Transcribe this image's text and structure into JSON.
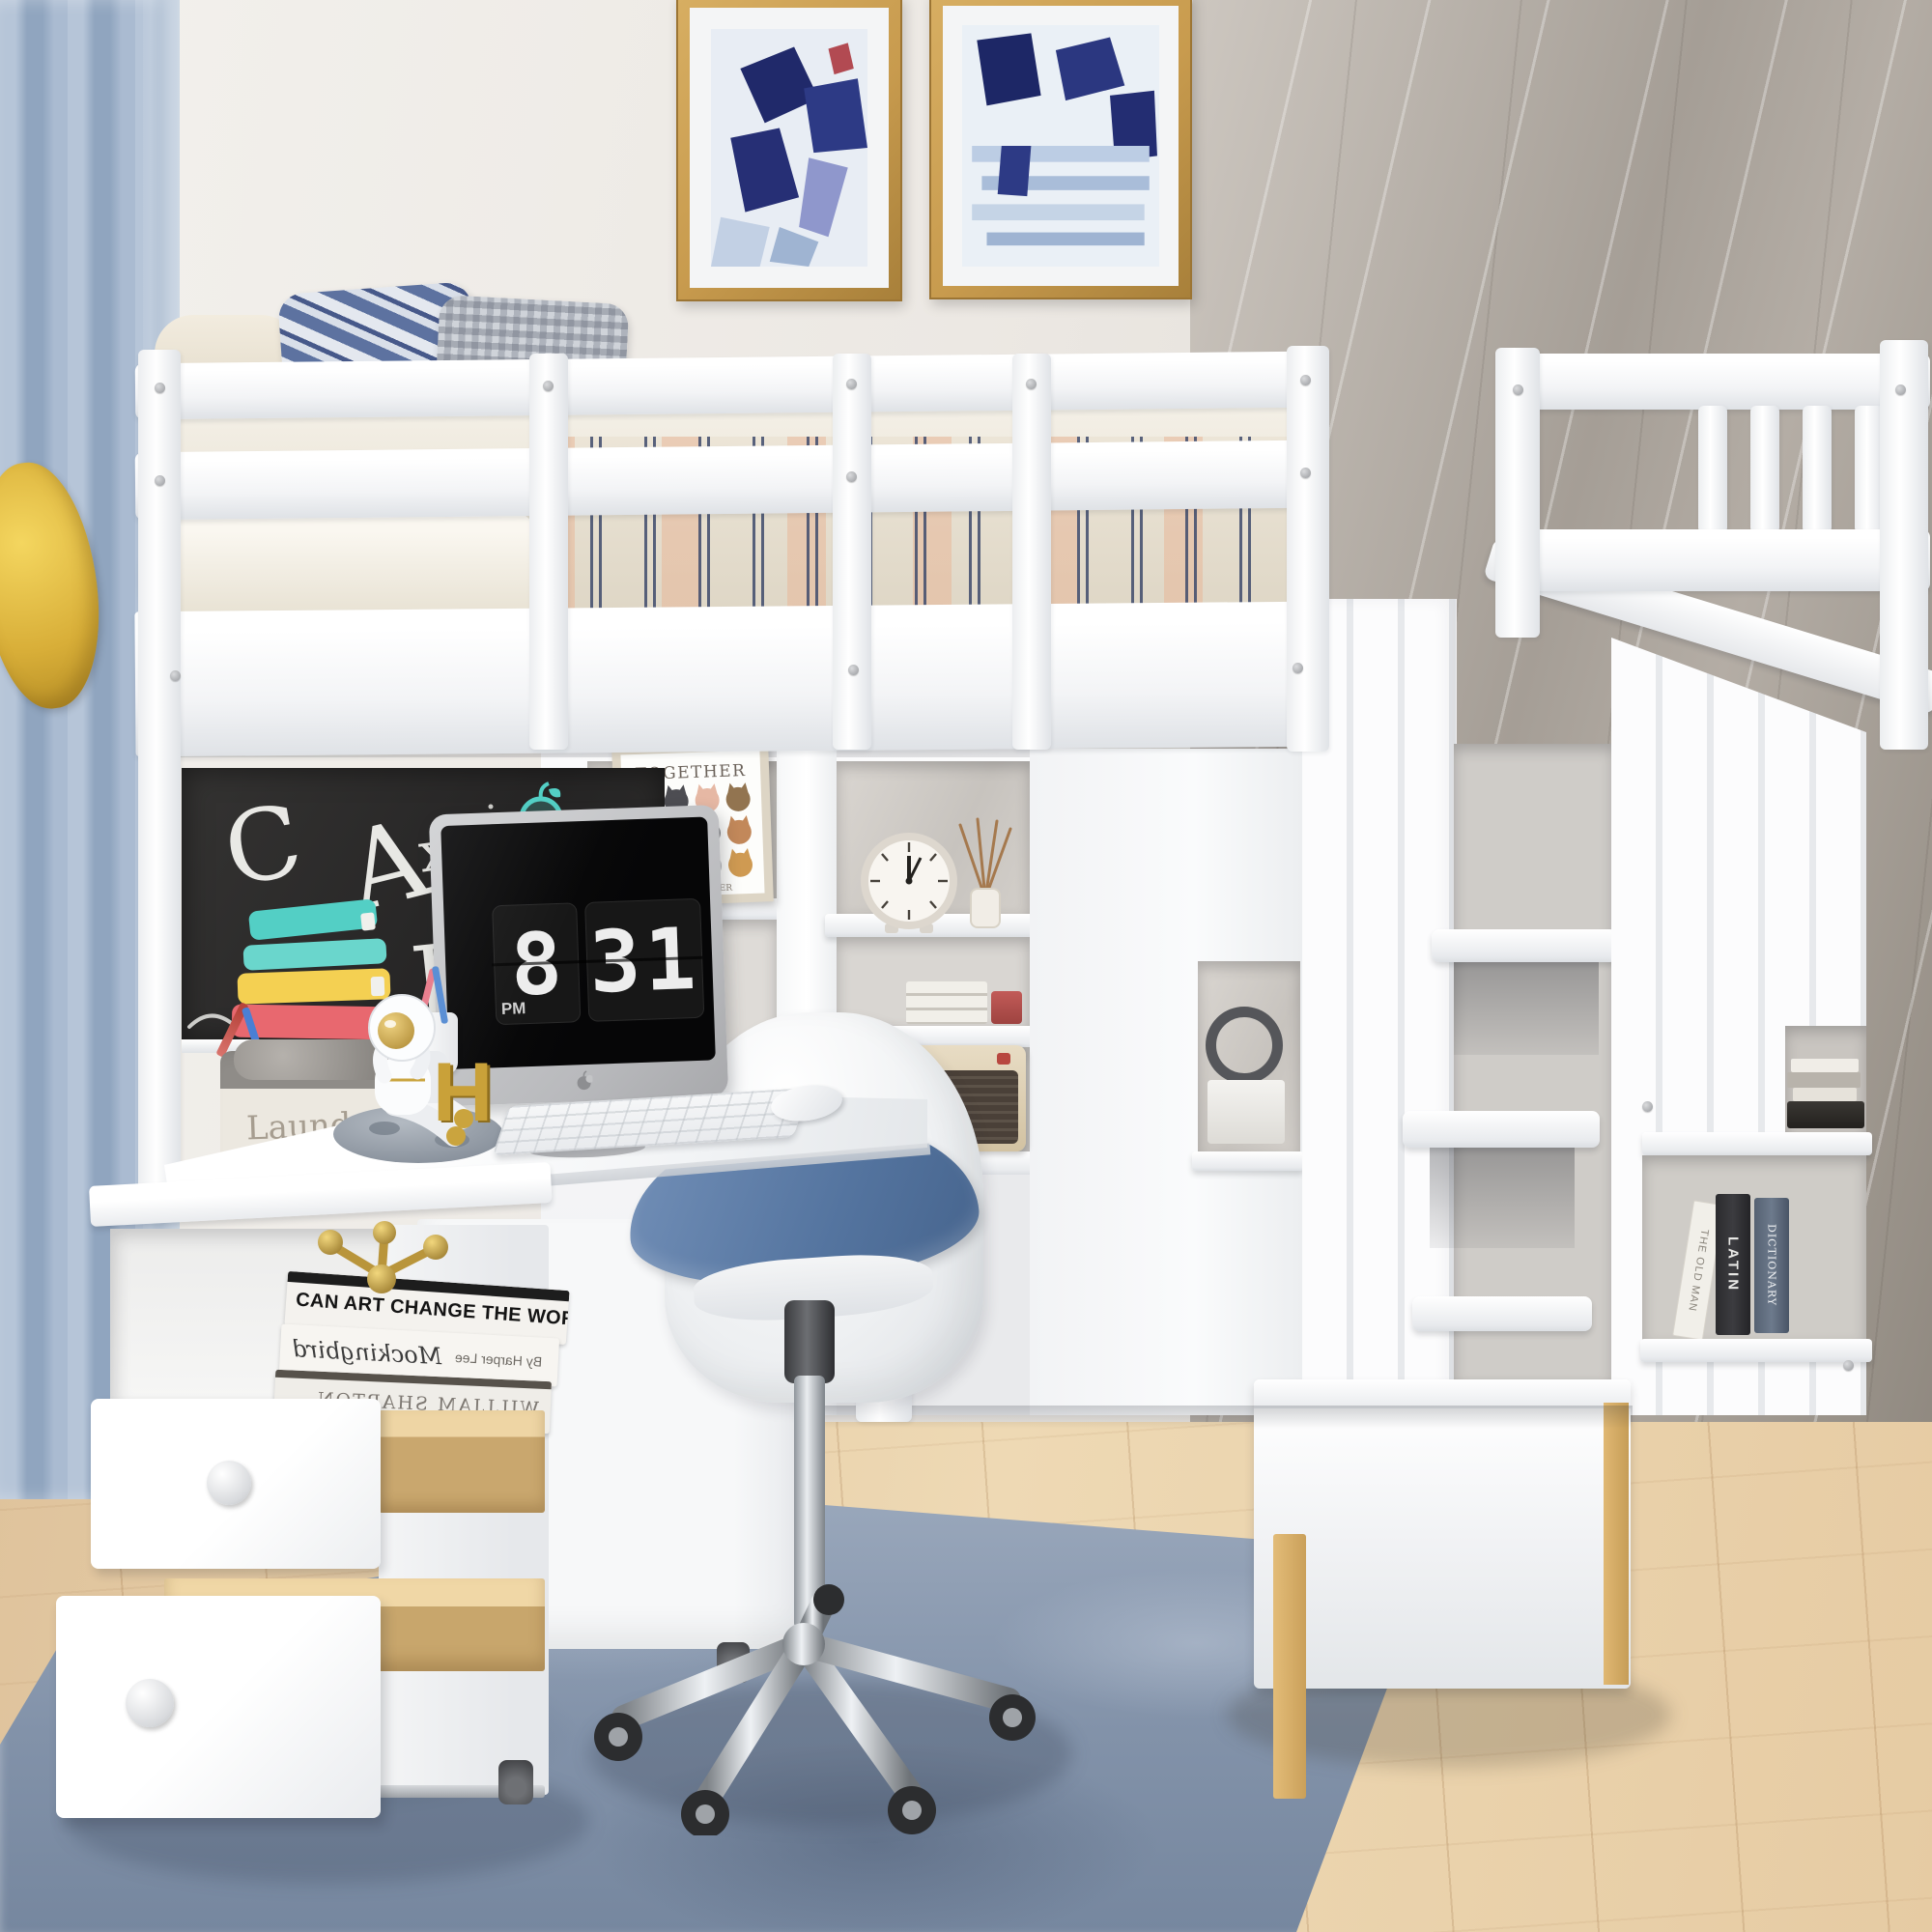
{
  "scene": {
    "subject": "Kids bedroom product photo: white twin loft bed with built-in desk, shelves, chalkboard, rolling drawer cart and storage staircase",
    "setting": "bedroom with blue curtains, marble wall, wood floor and blue rug"
  },
  "chalkboard": {
    "letter_c": "C",
    "letter_a": "A",
    "letter_x": "x",
    "letter_b": "B"
  },
  "computer_screen": {
    "clock_hour": "8",
    "clock_minutes": "31",
    "clock_meridiem": "PM"
  },
  "cat_poster": {
    "title": "TOGETHER",
    "caption": "WE ARE POWER"
  },
  "laundry_basket": {
    "label": "Laundry"
  },
  "bookend": {
    "letter": "H"
  },
  "books": {
    "stack_top_title": "CAN ART CHANGE THE WORLD?",
    "stack_mid_title": "Mockingbird",
    "stack_mid_author": "By Harper Lee",
    "stack_bottom_title": "WILLIAM SHARTON",
    "spine_latin": "LATIN",
    "spine_dictionary": "DICTIONARY",
    "spine_leaning": "THE OLD MAN"
  },
  "colors": {
    "furniture_white": "#ffffff",
    "wall_white": "#f0ede9",
    "marble_gray": "#a9a29a",
    "curtain_blue": "#a9bcd3",
    "curtain_tie_yellow": "#e9c94f",
    "floor_wood": "#e5cba6",
    "rug_blue_gray": "#8b9ab0",
    "chalkboard_black": "#2e2d2c",
    "chalk_teal": "#53cfc5",
    "chalk_yellow": "#f4d052",
    "chalk_pink": "#e8686f",
    "seat_cushion_blue": "#5d80ad",
    "screen_black": "#0a0a0b",
    "gold_accent": "#c9a23c",
    "wood_accent": "#dcb36e"
  }
}
